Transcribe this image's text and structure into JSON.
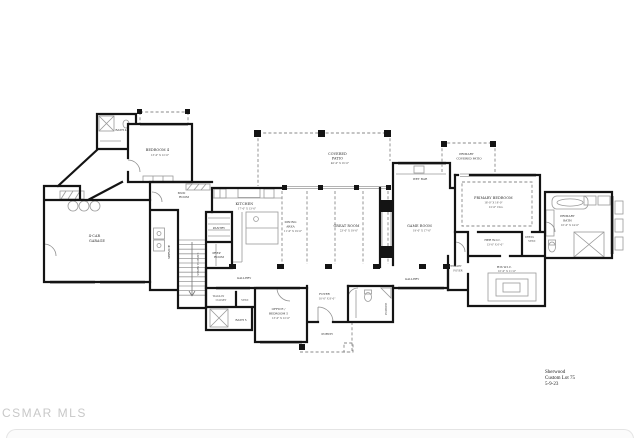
{
  "watermark": "CSMAR MLS",
  "title_block": {
    "line1": "Sherwood",
    "line2": "Custom Lot 75",
    "line3": "5-9-23"
  },
  "colors": {
    "wall": "#141414",
    "fixture": "#9a9a9a",
    "dashed": "#8a8a8a",
    "label": "#2e2e2e",
    "watermark": "#c8c8c8"
  },
  "rooms": {
    "bath4": {
      "label": "BATH 4"
    },
    "bedroom4": {
      "label": "BEDROOM 4",
      "dims": "13'-0\" X 12'-6\""
    },
    "mud_room": {
      "l1": "MUD",
      "l2": "ROOM"
    },
    "garage": {
      "l1": "4-CAR",
      "l2": "GARAGE"
    },
    "service": {
      "label": "SERVICE"
    },
    "stairs": {
      "label": "STAIRS TO BSMT."
    },
    "pantry": {
      "label": "PANTRY"
    },
    "prep_room": {
      "l1": "PREP",
      "l2": "ROOM"
    },
    "kitchen": {
      "label": "KITCHEN",
      "dims": "17'-0\" X 13'-0\""
    },
    "dining_area": {
      "l1": "DINING",
      "l2": "AREA",
      "dims": "11'-0\" X 19'-0\""
    },
    "great_room": {
      "label": "GREAT ROOM",
      "dims": "23'-0\" X 19'-0\""
    },
    "covered_patio": {
      "l1": "COVERED",
      "l2": "PATIO",
      "dims": "40'-0\" X 16'-0\""
    },
    "gallery_west": {
      "label": "GALLERY"
    },
    "gallery_east": {
      "label": "GALLERY"
    },
    "wet_bar": {
      "label": "WET BAR"
    },
    "game_room": {
      "label": "GAME ROOM",
      "dims": "19'-0\" X 17'-0\""
    },
    "primary_covered_patio": {
      "l1": "PRIMARY",
      "l2": "COVERED PATIO"
    },
    "primary_bedroom": {
      "label": "PRIMARY BEDROOM",
      "dims": "18'-0\" X 16'-0\"",
      "clg": "12'-0\" CLG."
    },
    "her_wic": {
      "label": "HER W.I.C.",
      "dims": "13'-0\" X 6'-0\""
    },
    "dress_vest": {
      "l1": "DRESS",
      "l2": "VEST."
    },
    "his_wic": {
      "label": "HIS W.I.C.",
      "dims": "16'-0\" X 11'-0\""
    },
    "primary_bath": {
      "l1": "PRIMARY",
      "l2": "BATH",
      "dims": "16'-0\" X 14'-0\""
    },
    "primary_foyer": {
      "l1": "PRIMARY",
      "l2": "FOYER"
    },
    "powder": {
      "label": "POWDER"
    },
    "foyer": {
      "label": "FOYER",
      "dims": "10'-0\" X 8'-0\""
    },
    "porch": {
      "label": "PORCH"
    },
    "office_bedroom5": {
      "l1": "OFFICE /",
      "l2": "BEDROOM 5",
      "dims": "13'-0\" X 12'-0\""
    },
    "walk_in_closet5": {
      "l1": "WALK-IN",
      "l2": "CLOSET"
    },
    "vest": {
      "label": "VEST."
    },
    "bath5": {
      "label": "BATH 5"
    }
  }
}
